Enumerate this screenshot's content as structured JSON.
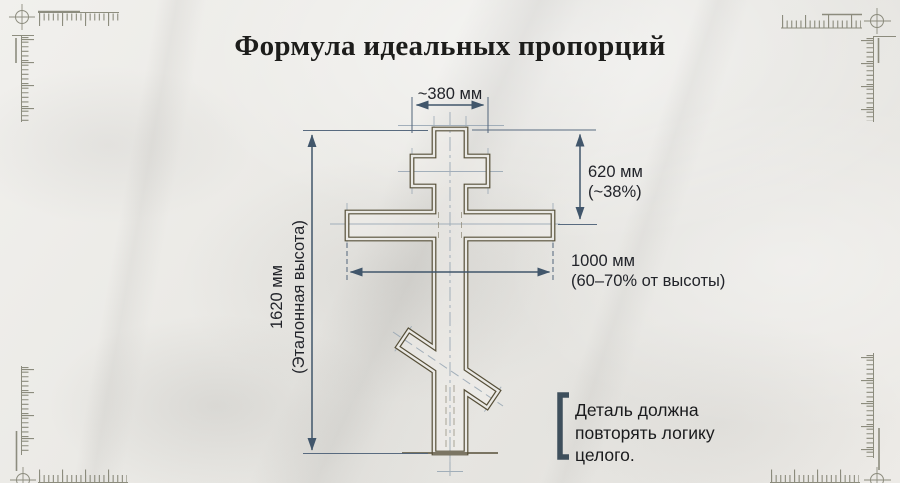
{
  "title": "Формула идеальных пропорций",
  "dimensions": {
    "top_width": {
      "value": "~380 мм"
    },
    "upper_section": {
      "value": "620 мм",
      "note": "(~38%)"
    },
    "crossbar": {
      "value": "1000 мм",
      "note": "(60–70% от высоты)"
    },
    "total_height": {
      "value": "1620 мм",
      "note": "(Эталонная высота)"
    }
  },
  "callout": {
    "lines": [
      "Деталь должна",
      "повторять логику",
      "целого."
    ]
  },
  "colors": {
    "dimension_line": "#41566b",
    "cross_outline": "#564f38",
    "callout_bracket": "#3e4f5c",
    "construction_line": "#96a5b3",
    "background": "#e9e8e4"
  }
}
